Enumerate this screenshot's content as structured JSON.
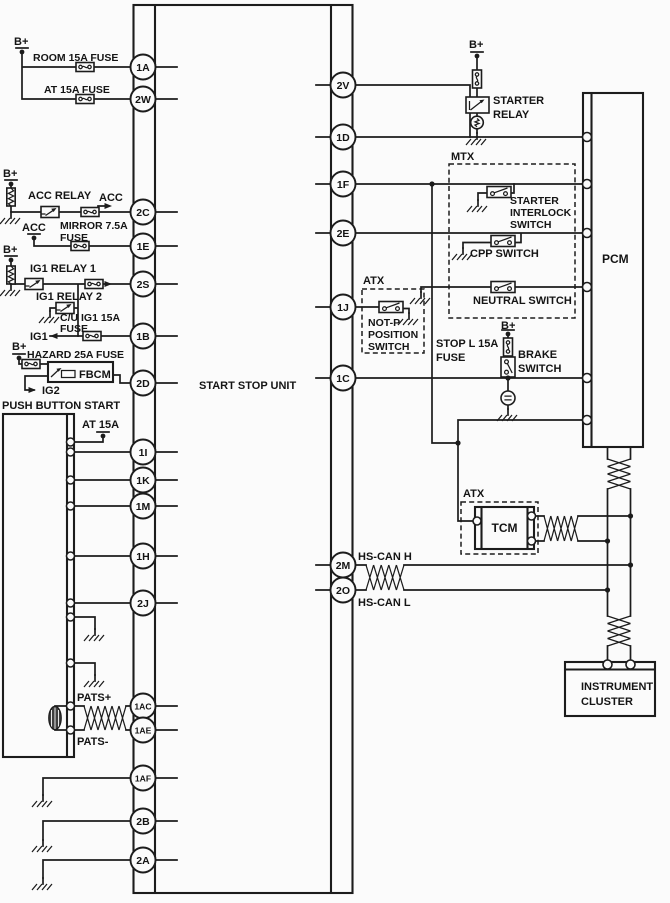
{
  "colors": {
    "line": "#1c1c1c",
    "background": "#fbfbfb"
  },
  "labels": {
    "b_plus": "B+",
    "room_fuse": "ROOM 15A FUSE",
    "at_fuse": "AT 15A FUSE",
    "acc_relay": "ACC RELAY",
    "acc": "ACC",
    "mirror_l1": "MIRROR 7.5A",
    "mirror_l2": "FUSE",
    "ig1_relay1": "IG1 RELAY 1",
    "ig1_relay2": "IG1 RELAY 2",
    "cu_l1": "C/U IG1 15A",
    "cu_l2": "FUSE",
    "ig1": "IG1",
    "hazard": "HAZARD 25A FUSE",
    "fbcm": "FBCM",
    "ig2": "IG2",
    "push_button": "PUSH BUTTON START",
    "at_15a": "AT 15A",
    "pats_p": "PATS+",
    "pats_m": "PATS-",
    "unit": "START STOP UNIT",
    "starter_relay_l1": "STARTER",
    "starter_relay_l2": "RELAY",
    "mtx": "MTX",
    "sis_l1": "STARTER",
    "sis_l2": "INTERLOCK",
    "sis_l3": "SWITCH",
    "cpp": "CPP SWITCH",
    "neutral": "NEUTRAL SWITCH",
    "atx": "ATX",
    "notp_l1": "NOT-P",
    "notp_l2": "POSITION",
    "notp_l3": "SWITCH",
    "stop_l1": "STOP L 15A",
    "stop_l2": "FUSE",
    "brake_l1": "BRAKE",
    "brake_l2": "SWITCH",
    "pcm": "PCM",
    "tcm": "TCM",
    "hscan_h": "HS-CAN H",
    "hscan_l": "HS-CAN L",
    "cluster_l1": "INSTRUMENT",
    "cluster_l2": "CLUSTER"
  },
  "pins_left": [
    "1A",
    "2W",
    "2C",
    "1E",
    "2S",
    "1B",
    "2D",
    "1I",
    "1K",
    "1M",
    "1H",
    "2J",
    "1AC",
    "1AE",
    "1AF",
    "2B",
    "2A"
  ],
  "pins_right": [
    "2V",
    "1D",
    "1F",
    "2E",
    "1J",
    "1C",
    "2M",
    "2O"
  ]
}
